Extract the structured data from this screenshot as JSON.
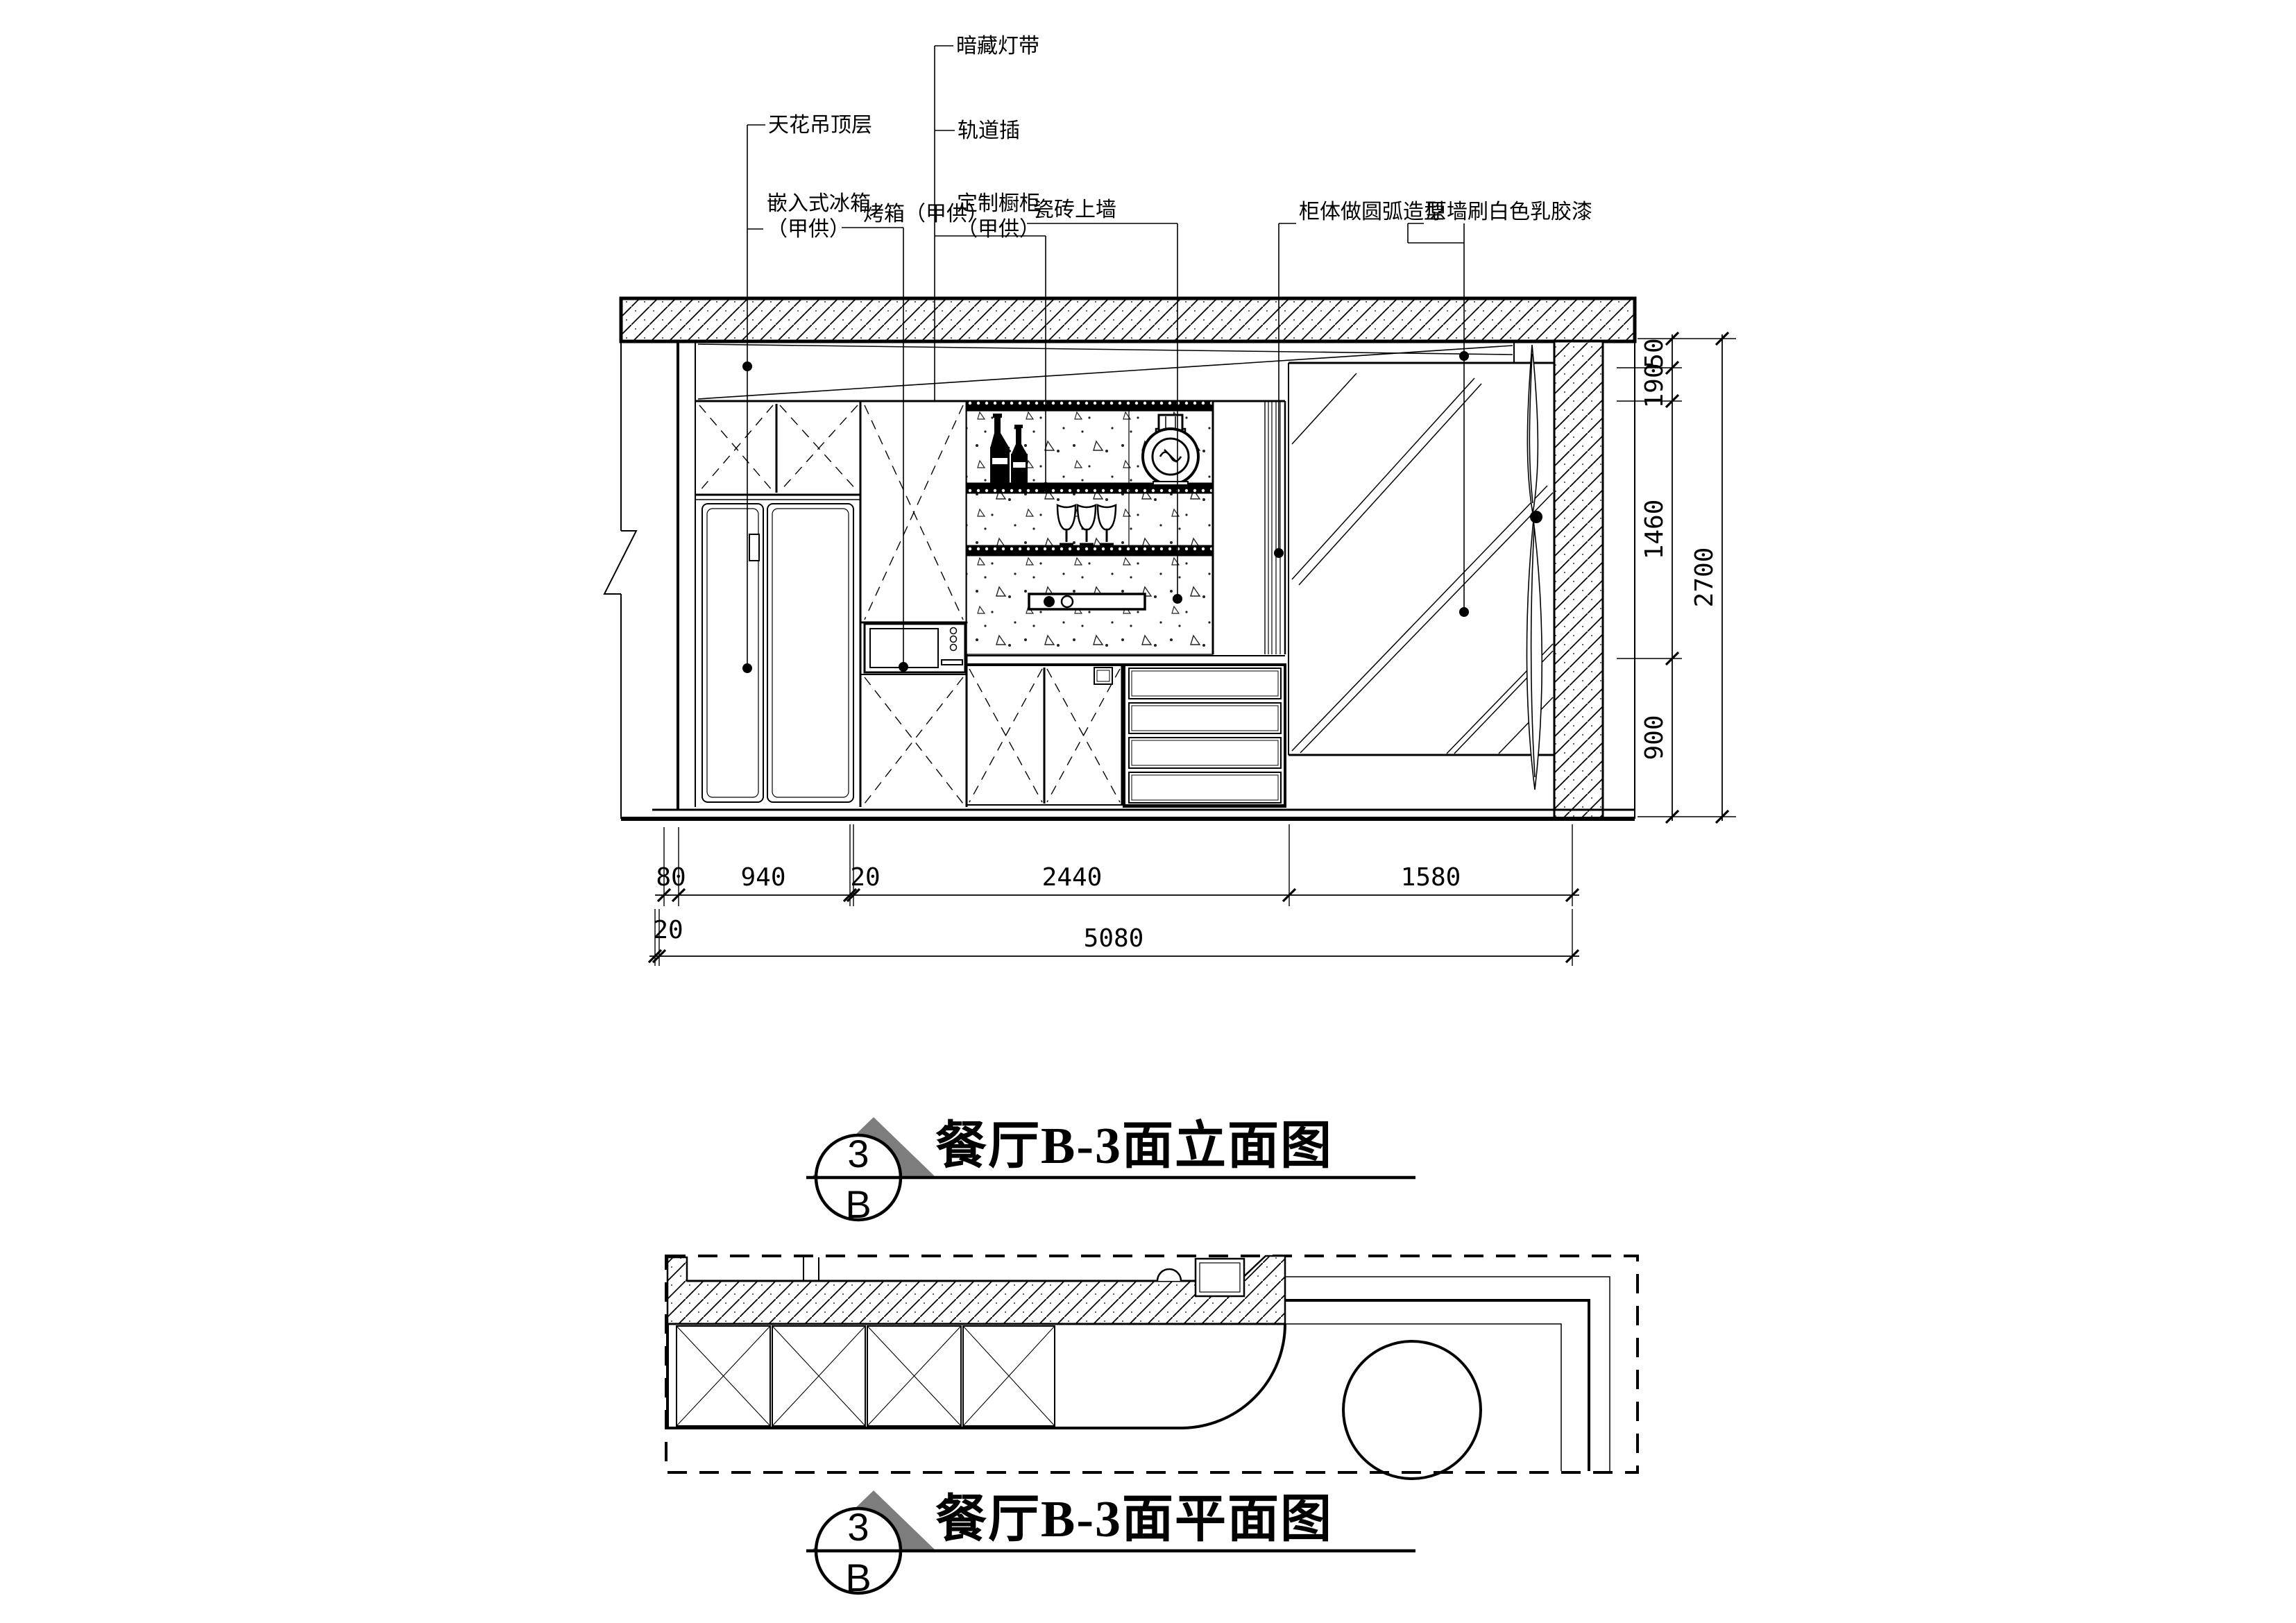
{
  "colors": {
    "ink": "#000000",
    "background": "#ffffff",
    "marker_gray": "#7d7d7d"
  },
  "callouts": {
    "led": "暗藏灯带",
    "track": "轨道插",
    "ceiling": "天花吊顶层",
    "fridge_line1": "嵌入式冰箱",
    "fridge_line2": "（甲供）",
    "oven": "烤箱（甲供）",
    "cabinet_line1": "定制橱柜",
    "cabinet_line2": "（甲供）",
    "tile": "瓷砖上墙",
    "arc_cabinet": "柜体做圆弧造型",
    "wall_paint": "原墙刷白色乳胶漆"
  },
  "dims": {
    "vertical": [
      "50",
      "190",
      "1460",
      "900"
    ],
    "vertical_total": "2700",
    "horizontal": [
      "80",
      "940",
      "20",
      "2440",
      "1580"
    ],
    "horizontal_inset": "20",
    "horizontal_total": "5080"
  },
  "titles": {
    "elevation": {
      "num": "3",
      "letter": "B",
      "text": "餐厅B-3面立面图"
    },
    "plan": {
      "num": "3",
      "letter": "B",
      "text": "餐厅B-3面平面图"
    }
  }
}
